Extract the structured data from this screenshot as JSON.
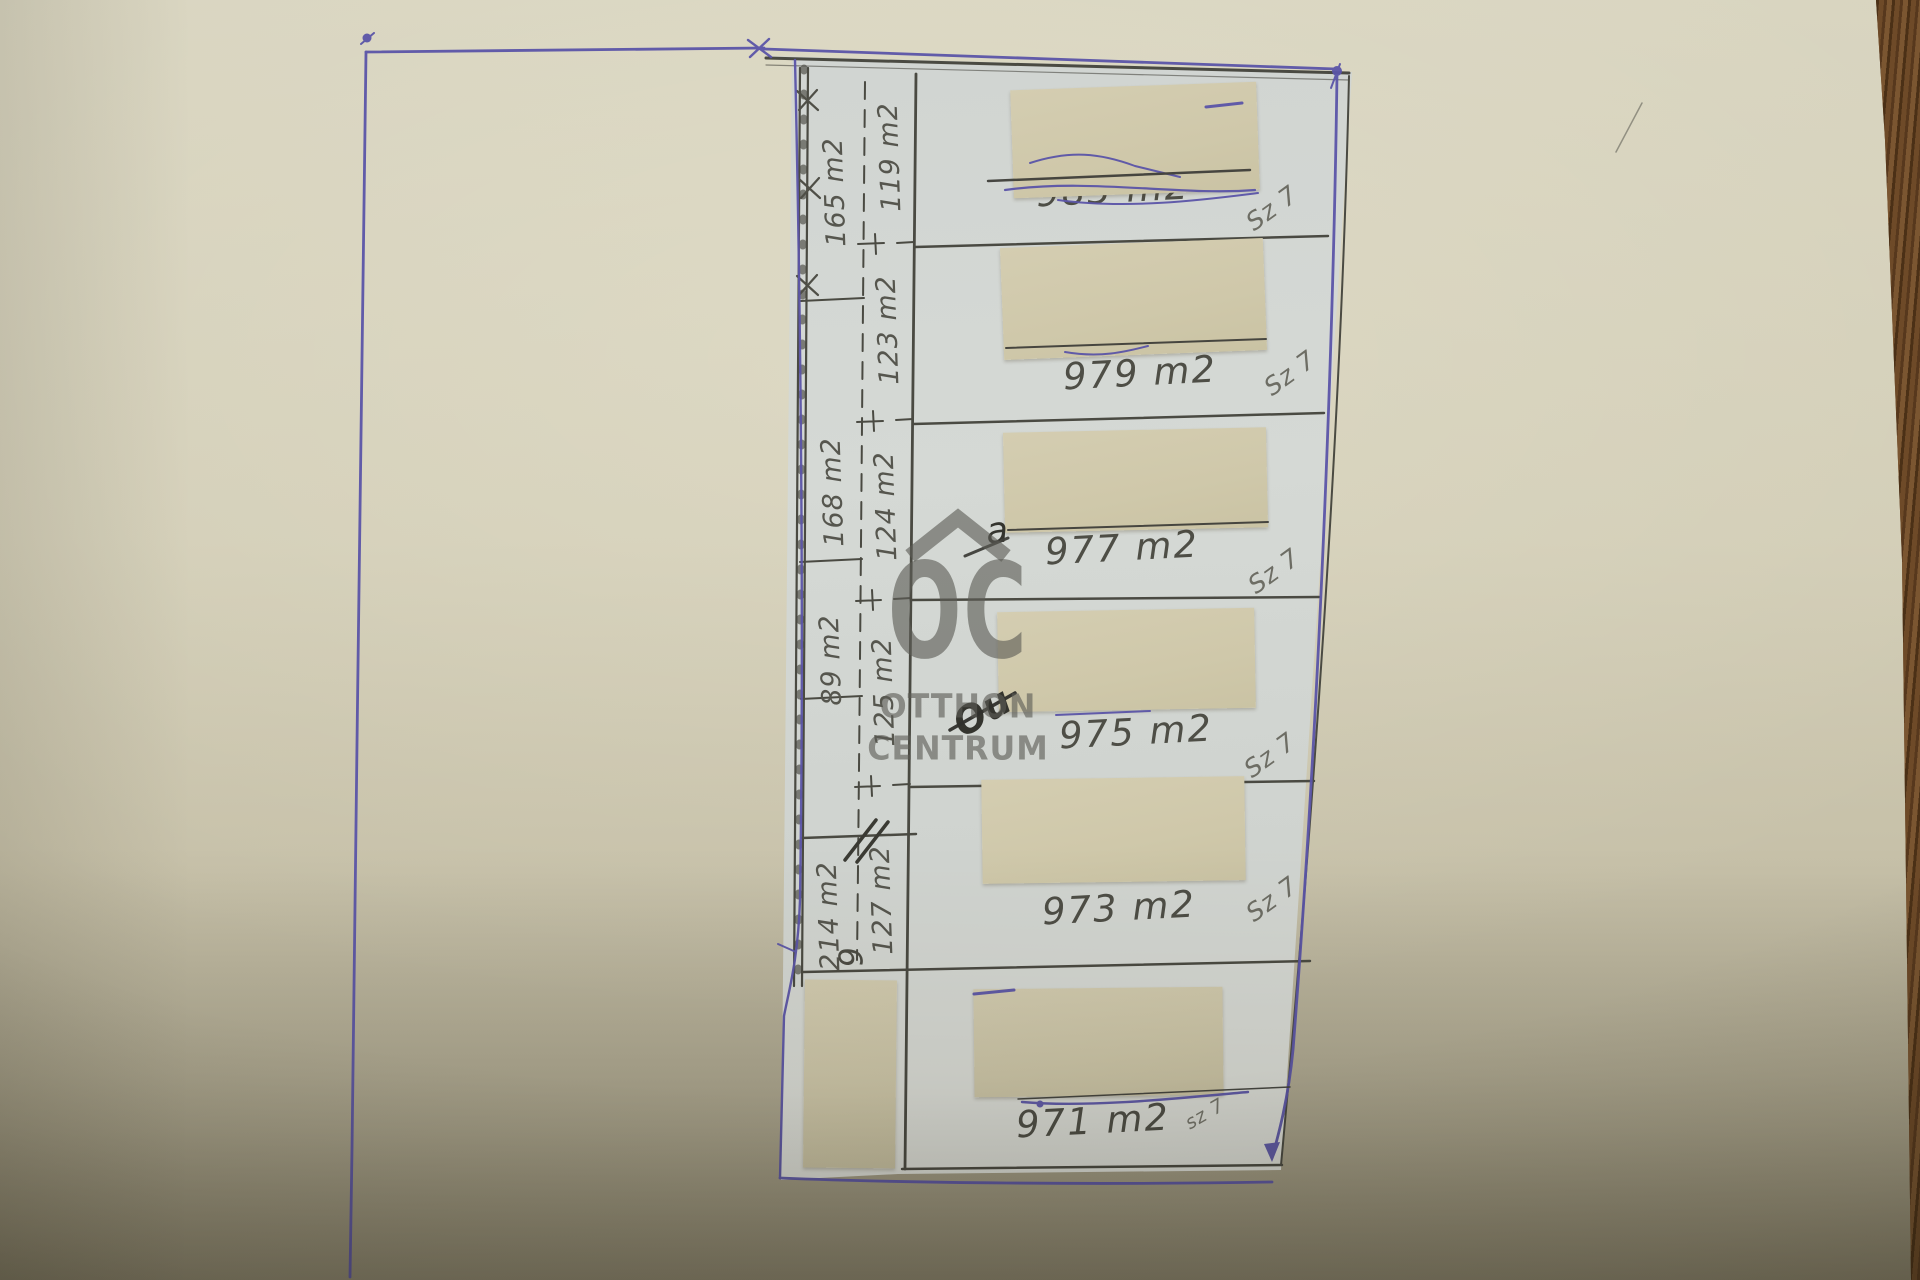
{
  "watermark": {
    "brand_short": "OC",
    "brand_line1": "OTTHON",
    "brand_line2": "CENTRUM"
  },
  "strip": {
    "left_labels": [
      "165 m2",
      "168 m2",
      "89 m2",
      "214 m2"
    ],
    "right_labels": [
      "119 m2",
      "123 m2",
      "124 m2",
      "125 m2",
      "127 m2"
    ],
    "corner_note": "9"
  },
  "parcels": [
    {
      "area": "983 m2",
      "zone": "Sz 7"
    },
    {
      "area": "979 m2",
      "zone": "Sz 7"
    },
    {
      "area": "977 m2",
      "zone": "Sz 7"
    },
    {
      "area": "975 m2",
      "zone": "Sz 7"
    },
    {
      "area": "973 m2",
      "zone": "Sz 7"
    },
    {
      "area": "971 m2",
      "zone": "sz 7"
    }
  ],
  "annotations": {
    "letter_a": "a",
    "ou_mark": "Ou"
  }
}
